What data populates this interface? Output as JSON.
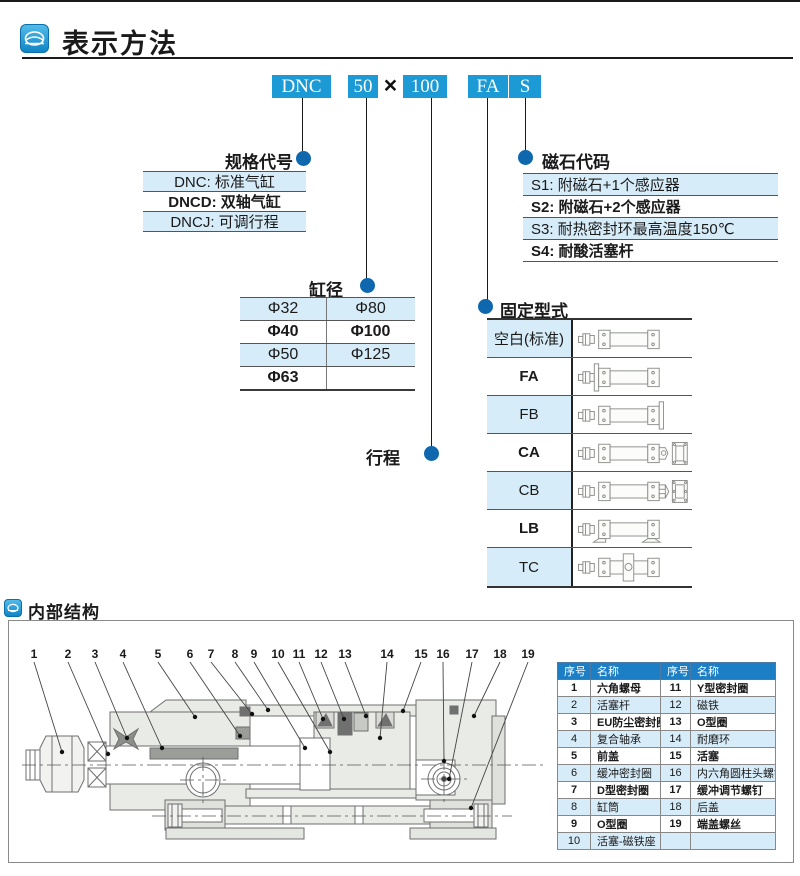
{
  "page": {
    "title": "表示方法",
    "section2_title": "内部结构"
  },
  "colors": {
    "accent": "#1B9AD6",
    "dot": "#0F67AE",
    "row_highlight": "#D7ECF9",
    "table_header": "#1C7FC6"
  },
  "model_code": {
    "boxes": [
      "DNC",
      "50",
      "100",
      "FA",
      "S"
    ],
    "separator": "×"
  },
  "callout_labels": {
    "spec": "规格代号",
    "bore": "缸径",
    "stroke": "行程",
    "mount": "固定型式",
    "magnet": "磁石代码"
  },
  "spec_rows": [
    {
      "text": "DNC: 标准气缸",
      "highlight": true,
      "bold": false
    },
    {
      "text": "DNCD: 双轴气缸",
      "highlight": false,
      "bold": true
    },
    {
      "text": "DNCJ: 可调行程",
      "highlight": true,
      "bold": false
    }
  ],
  "bore_table": {
    "rows": [
      {
        "cells": [
          "Φ32",
          "Φ80"
        ],
        "highlight": true,
        "bold": false
      },
      {
        "cells": [
          "Φ40",
          "Φ100"
        ],
        "highlight": false,
        "bold": true
      },
      {
        "cells": [
          "Φ50",
          "Φ125"
        ],
        "highlight": true,
        "bold": false
      },
      {
        "cells": [
          "Φ63",
          ""
        ],
        "highlight": false,
        "bold": true
      }
    ]
  },
  "magnet_rows": [
    {
      "text": "S1: 附磁石+1个感应器",
      "highlight": true,
      "bold": false
    },
    {
      "text": "S2: 附磁石+2个感应器",
      "highlight": false,
      "bold": true
    },
    {
      "text": "S3: 耐热密封环最高温度150℃",
      "highlight": true,
      "bold": false
    },
    {
      "text": "S4: 耐酸活塞杆",
      "highlight": false,
      "bold": true
    }
  ],
  "mount_rows": [
    {
      "label": "空白(标准)",
      "variant": "basic",
      "highlight": true,
      "bold": false
    },
    {
      "label": "FA",
      "variant": "fa",
      "highlight": false,
      "bold": true
    },
    {
      "label": "FB",
      "variant": "fb",
      "highlight": true,
      "bold": false
    },
    {
      "label": "CA",
      "variant": "ca",
      "highlight": false,
      "bold": true
    },
    {
      "label": "CB",
      "variant": "cb",
      "highlight": true,
      "bold": false
    },
    {
      "label": "LB",
      "variant": "lb",
      "highlight": false,
      "bold": true
    },
    {
      "label": "TC",
      "variant": "tc",
      "highlight": true,
      "bold": false
    }
  ],
  "parts_table": {
    "headers": [
      "序号",
      "名称",
      "序号",
      "名称"
    ],
    "rows": [
      [
        "1",
        "六角螺母",
        "11",
        "Y型密封圈"
      ],
      [
        "2",
        "活塞杆",
        "12",
        "磁铁"
      ],
      [
        "3",
        "EU防尘密封圈",
        "13",
        "O型圈"
      ],
      [
        "4",
        "复合轴承",
        "14",
        "耐磨环"
      ],
      [
        "5",
        "前盖",
        "15",
        "活塞"
      ],
      [
        "6",
        "缓冲密封圈",
        "16",
        "内六角圆柱头螺钉"
      ],
      [
        "7",
        "D型密封圈",
        "17",
        "缓冲调节螺钉"
      ],
      [
        "8",
        "缸筒",
        "18",
        "后盖"
      ],
      [
        "9",
        "O型圈",
        "19",
        "端盖螺丝"
      ],
      [
        "10",
        "活塞-磁铁座",
        "",
        ""
      ]
    ]
  },
  "drawing": {
    "callout_numbers": [
      "1",
      "2",
      "3",
      "4",
      "5",
      "6",
      "7",
      "8",
      "9",
      "10",
      "11",
      "12",
      "13",
      "14",
      "15",
      "16",
      "17",
      "18",
      "19"
    ]
  }
}
